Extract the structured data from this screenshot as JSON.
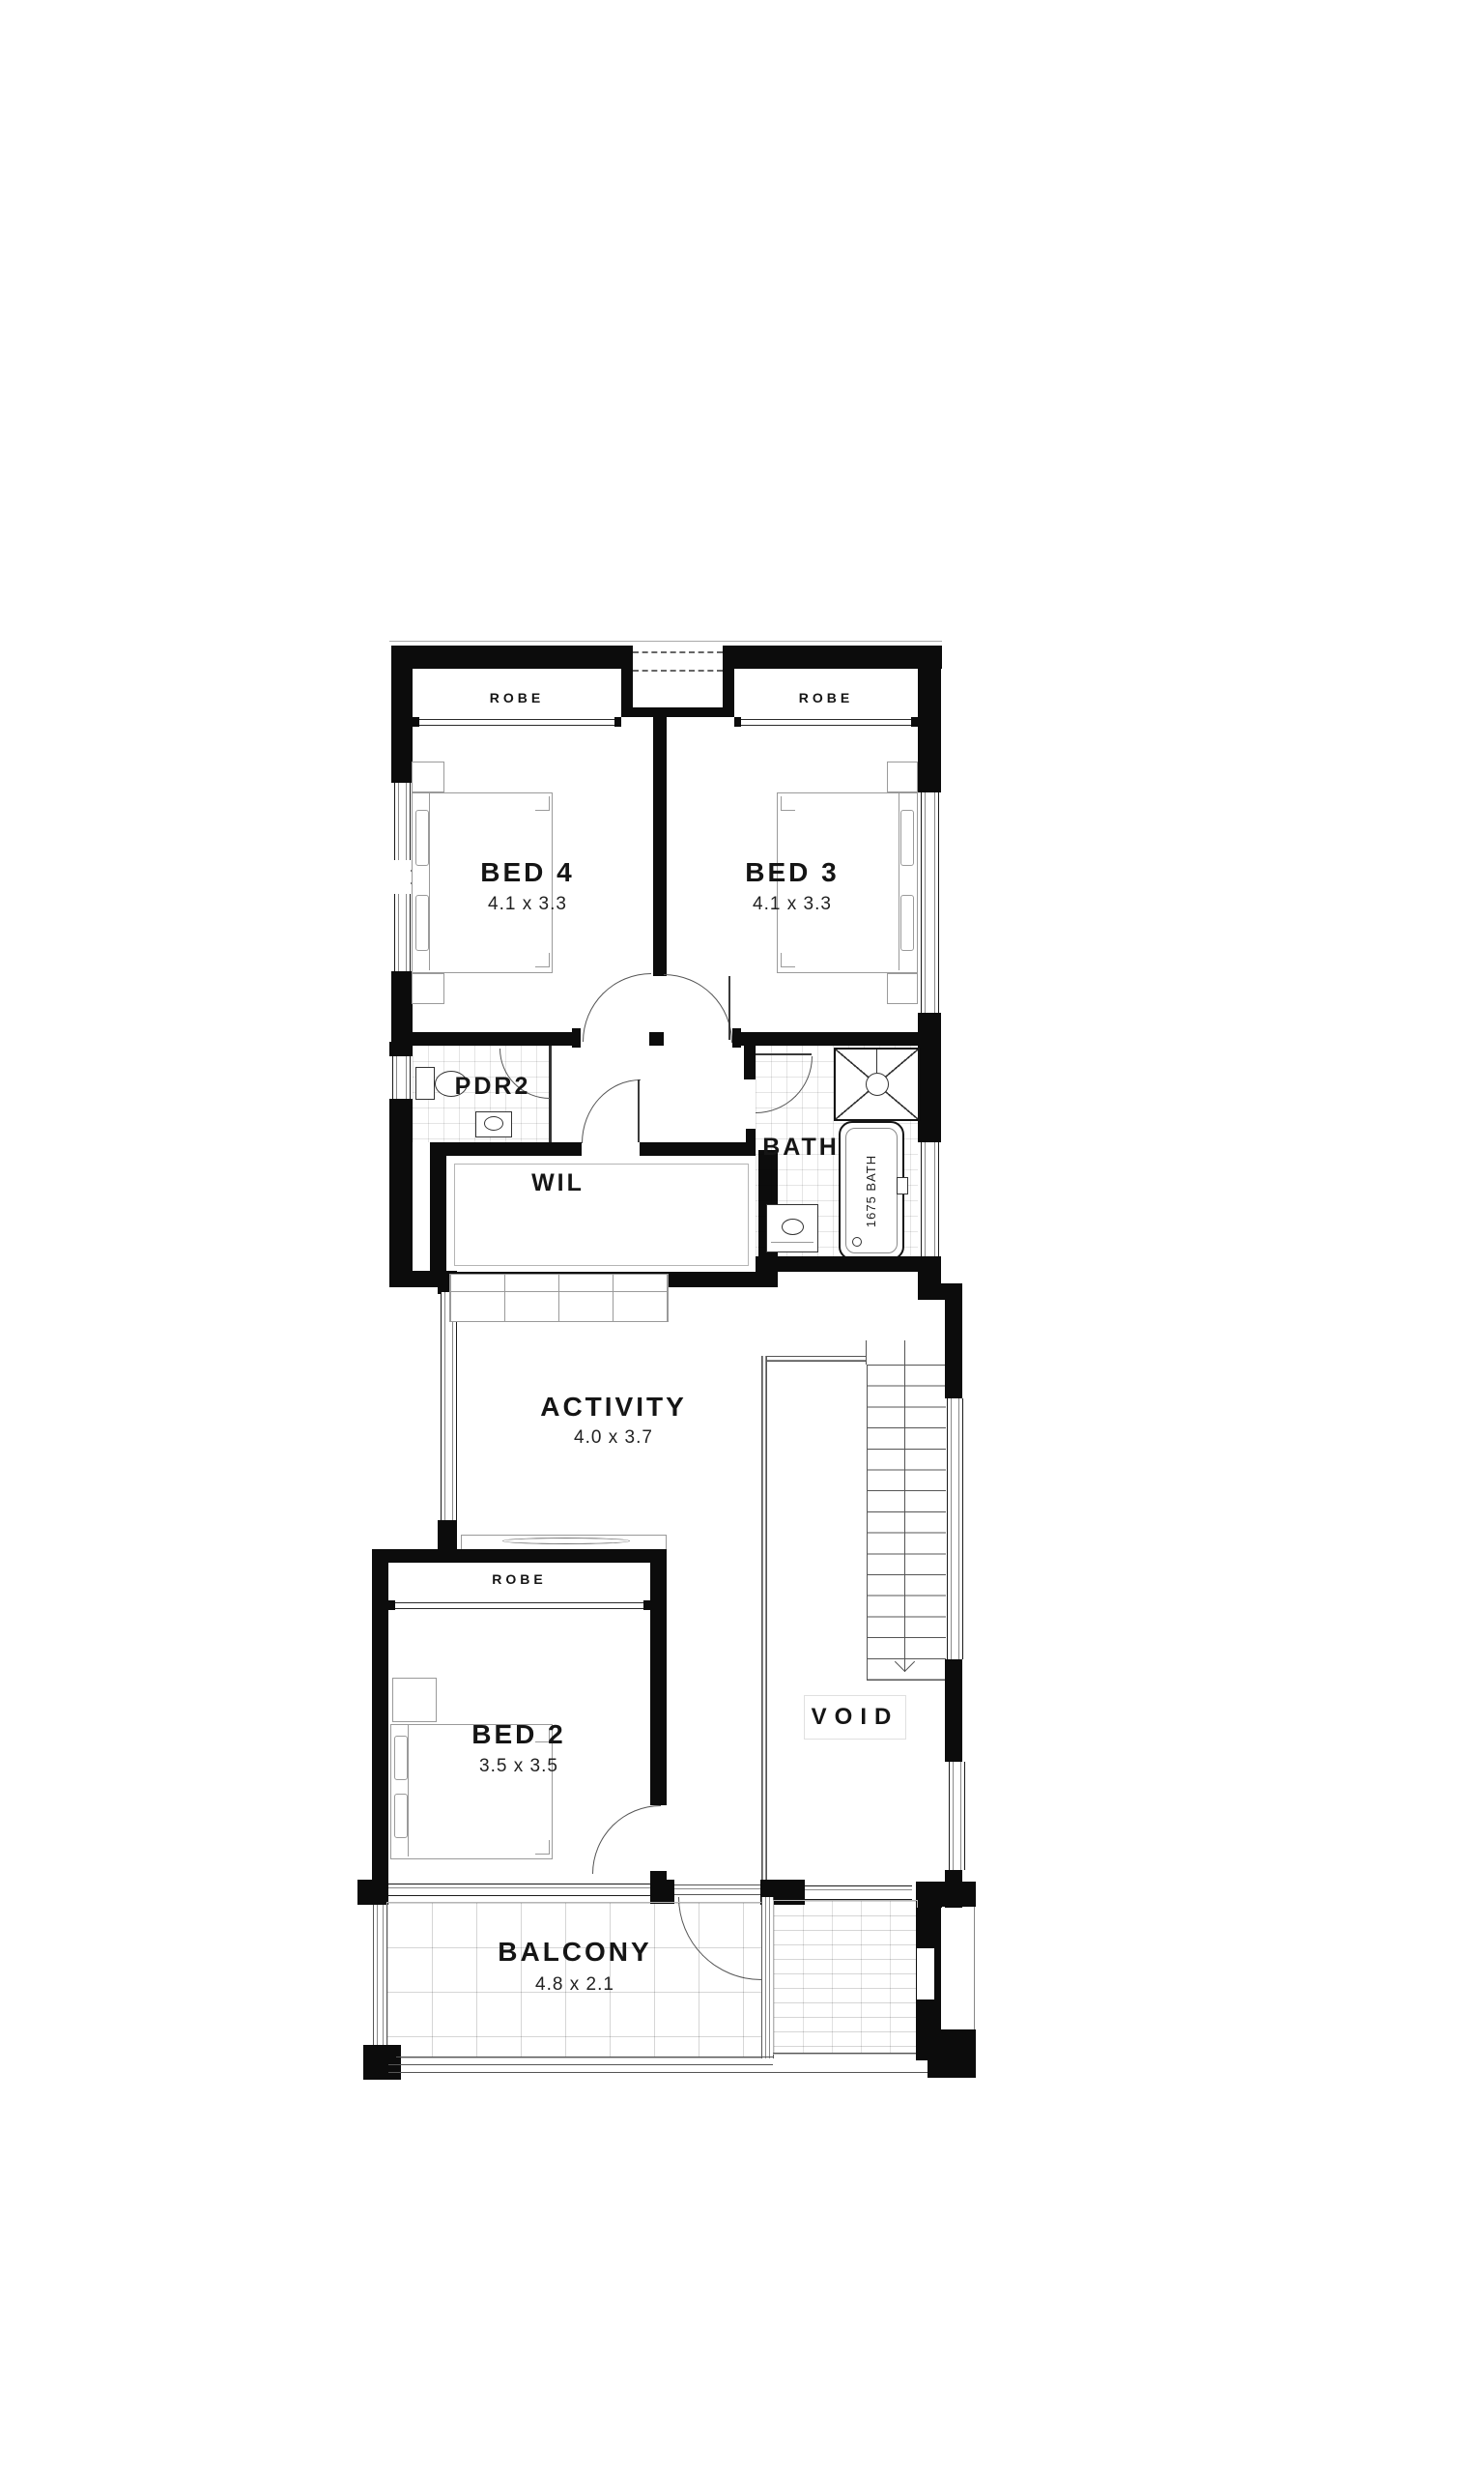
{
  "floorplan": {
    "north_label": "(N)",
    "rooms": {
      "robe_bed4": {
        "label": "ROBE"
      },
      "robe_bed3": {
        "label": "ROBE"
      },
      "bed4": {
        "label": "BED 4",
        "dims": "4.1 x 3.3"
      },
      "bed3": {
        "label": "BED 3",
        "dims": "4.1 x 3.3"
      },
      "pdr2": {
        "label": "PDR2"
      },
      "wil": {
        "label": "WIL"
      },
      "bath": {
        "label": "BATH"
      },
      "activity": {
        "label": "ACTIVITY",
        "dims": "4.0 x 3.7"
      },
      "robe_bed2": {
        "label": "ROBE"
      },
      "bed2": {
        "label": "BED 2",
        "dims": "3.5 x 3.5"
      },
      "void": {
        "label": "VOID"
      },
      "balcony": {
        "label": "BALCONY",
        "dims": "4.8 x 2.1"
      }
    },
    "fixtures": {
      "bathtub_label": "1675 BATH"
    },
    "colors": {
      "wall": "#0c0c0c",
      "line": "#555555",
      "faint": "#bfbfbf"
    }
  }
}
